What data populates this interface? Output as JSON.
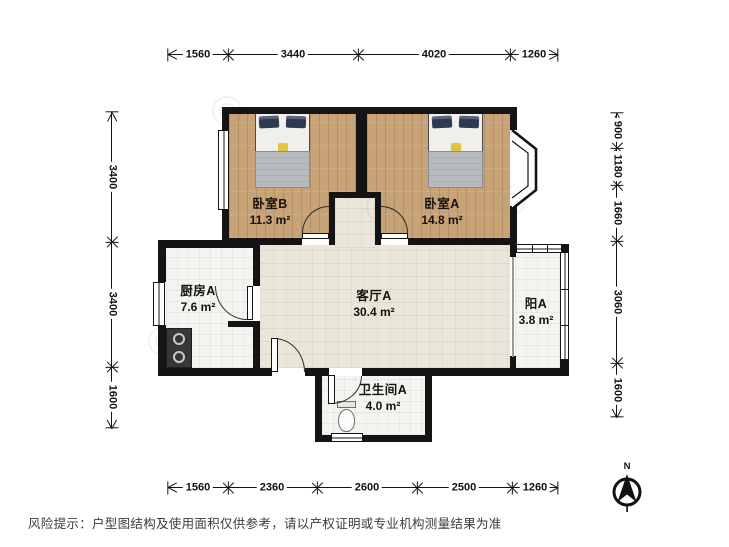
{
  "dims": {
    "top": [
      "1560",
      "3440",
      "4020",
      "1260"
    ],
    "bottom": [
      "1560",
      "2360",
      "2600",
      "2500",
      "1260"
    ],
    "left": [
      "3400",
      "3400",
      "1600"
    ],
    "right": [
      "900",
      "1180",
      "1660",
      "3060",
      "1600"
    ]
  },
  "rooms": [
    {
      "id": "bedroom-b",
      "name": "卧室B",
      "area": "11.3 m²"
    },
    {
      "id": "bedroom-a",
      "name": "卧室A",
      "area": "14.8 m²"
    },
    {
      "id": "kitchen",
      "name": "厨房A",
      "area": "7.6 m²"
    },
    {
      "id": "living",
      "name": "客厅A",
      "area": "30.4 m²"
    },
    {
      "id": "balcony",
      "name": "阳A",
      "area": "3.8 m²"
    },
    {
      "id": "bathroom",
      "name": "卫生间A",
      "area": "4.0 m²"
    }
  ],
  "compass": {
    "label": "N"
  },
  "footer": {
    "disclaimer": "风险提示：户型图结构及使用面积仅供参考，请以产权证明或专业机构测量结果为准"
  },
  "colors": {
    "wall": "#141414",
    "wood_floor": "#c8a377",
    "living_floor": "#eae6d9",
    "tile_floor": "#f4f4f1",
    "bed_pillow": "#2e3a52",
    "bed_accent": "#e6c33c"
  }
}
